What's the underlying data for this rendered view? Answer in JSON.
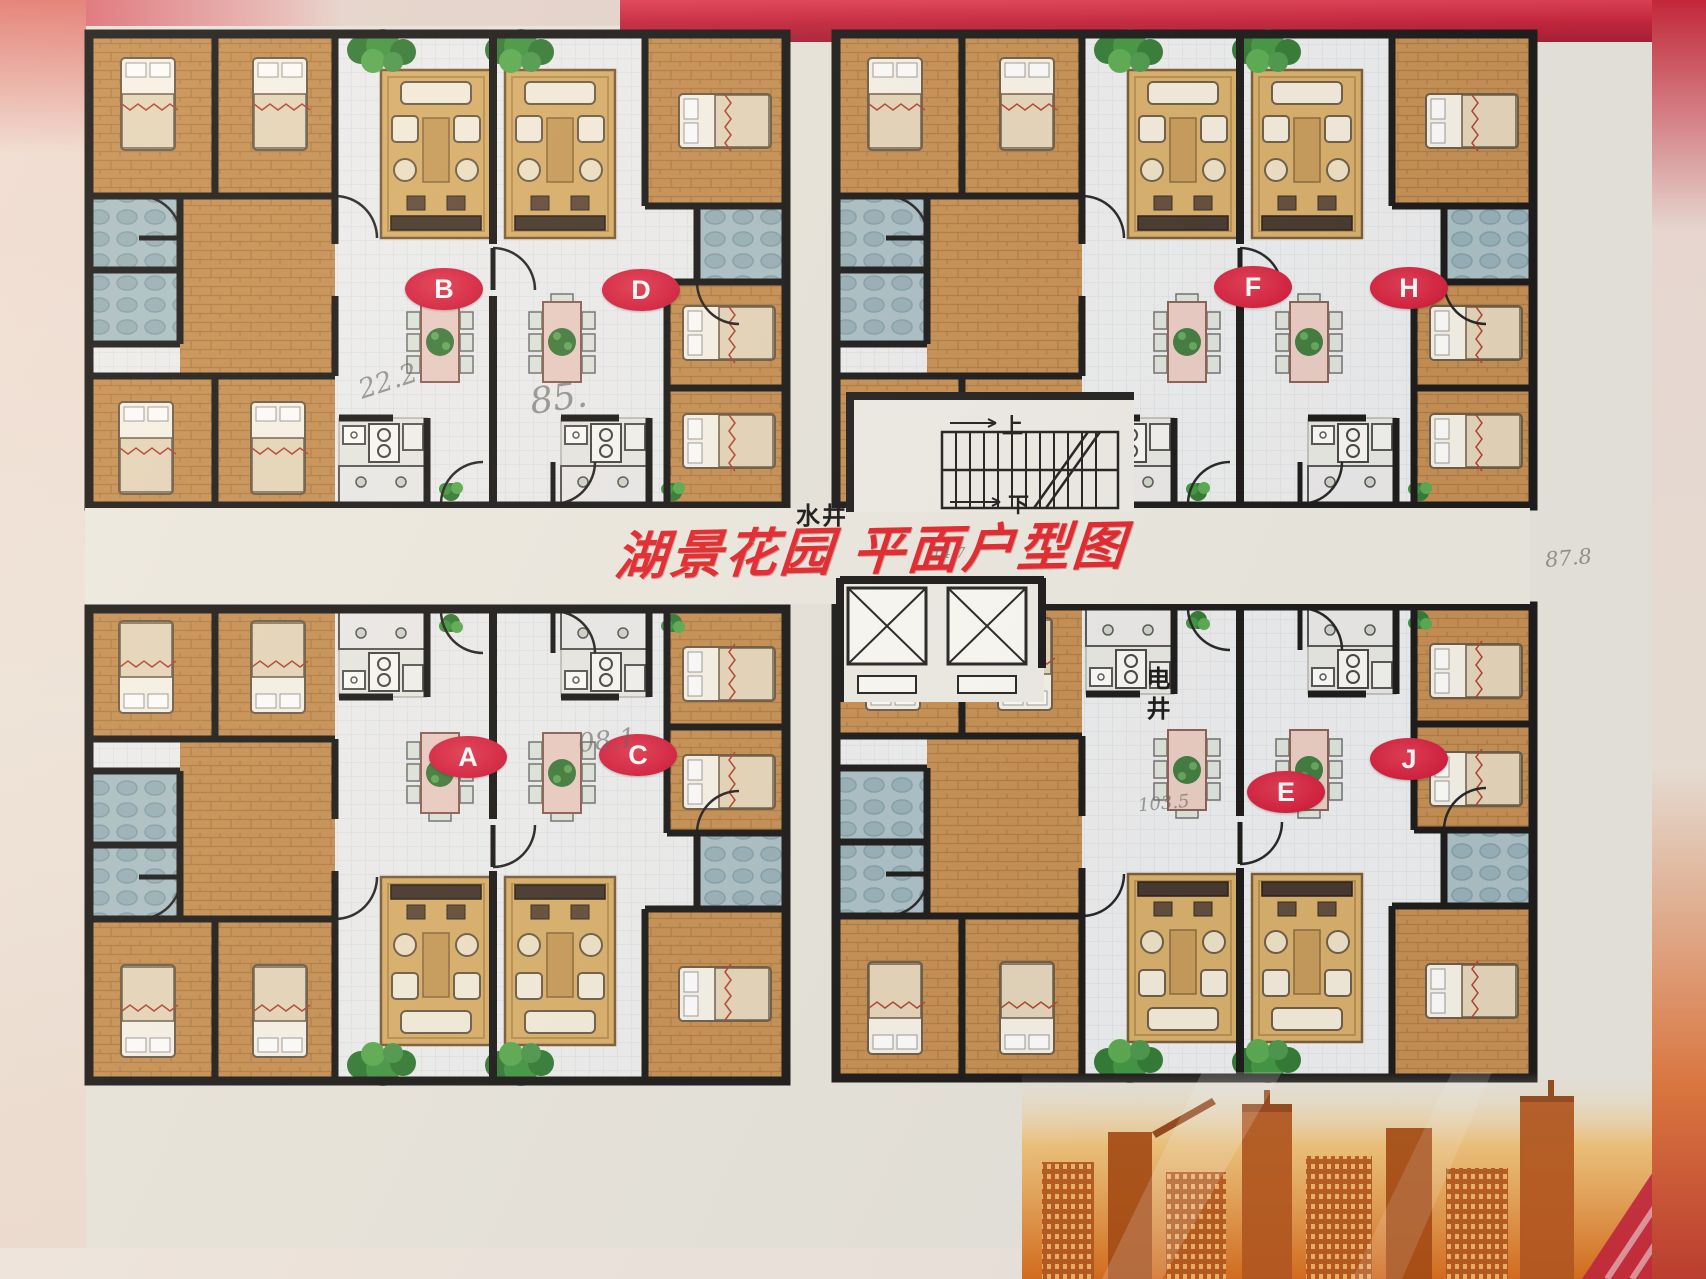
{
  "title": "湖景花园 平面户型图",
  "badges": [
    {
      "id": "B",
      "label": "B"
    },
    {
      "id": "D",
      "label": "D"
    },
    {
      "id": "F",
      "label": "F"
    },
    {
      "id": "H",
      "label": "H"
    },
    {
      "id": "A",
      "label": "A"
    },
    {
      "id": "C",
      "label": "C"
    },
    {
      "id": "E",
      "label": "E"
    },
    {
      "id": "J",
      "label": "J"
    }
  ],
  "core_labels": {
    "water_shaft": "水井",
    "electric_shaft": "电井",
    "stairs_up": "上",
    "stairs_down": "下"
  },
  "annotations": [
    {
      "text": "22.2"
    },
    {
      "text": "85."
    },
    {
      "text": "08.1"
    },
    {
      "text": "14.7"
    },
    {
      "text": "87.8"
    },
    {
      "text": "103.5"
    }
  ],
  "colors": {
    "badge_red": "#d81f3f",
    "title_red": "#e5232b",
    "wall_black": "#161616",
    "wood_floor": "#c68f52",
    "bath_tile": "#aac1c8",
    "rug_tan": "#d9b06a",
    "poster_background": "#e9e7df",
    "skyline_orange": "#e8891f"
  }
}
